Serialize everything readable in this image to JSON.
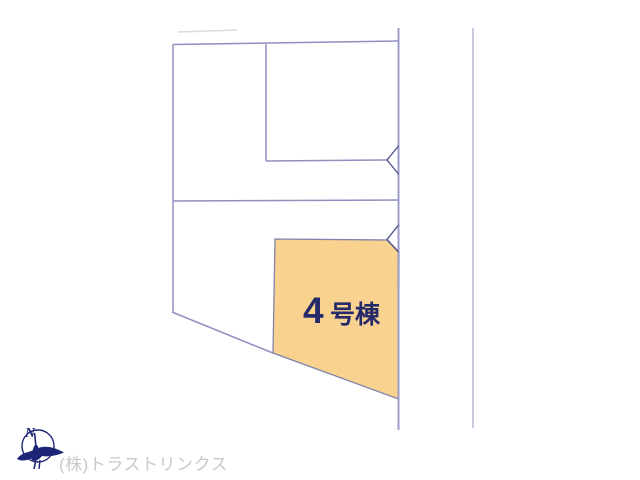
{
  "site_plan": {
    "parcel": {
      "label_number": "4",
      "label_suffix": "号棟",
      "fill": "#f8d28e",
      "label_color": "#252a6b"
    },
    "colors": {
      "boundary_line": "#8f90c0",
      "road_line": "#9b9cc9",
      "entrance_chevron": "#4a4f88",
      "faint_line": "#d9dae3"
    }
  },
  "compass": {
    "north_label": "N",
    "color": "#1c2476"
  },
  "watermark": {
    "company": "(株)トラストリンクス",
    "color": "#c9c9c9"
  }
}
